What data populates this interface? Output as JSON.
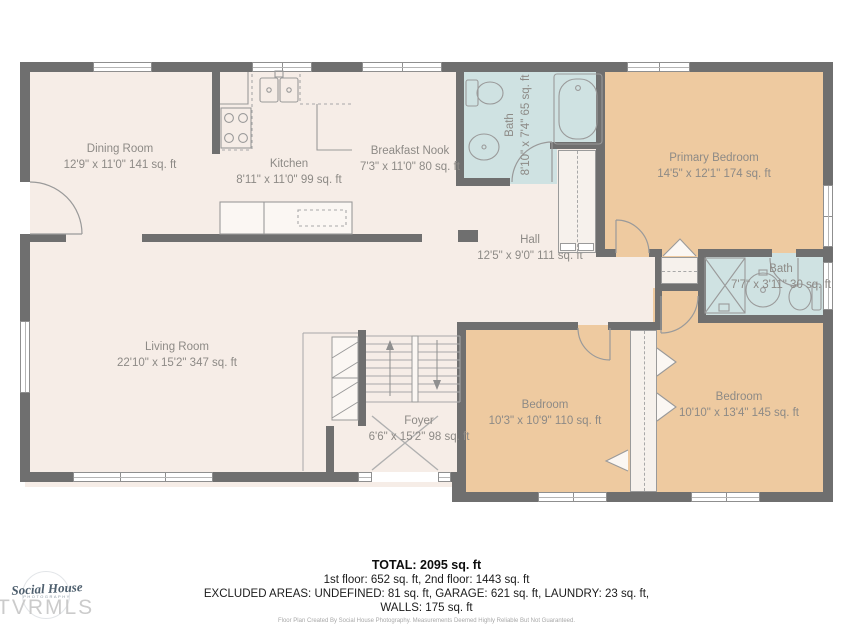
{
  "rooms": {
    "dining": {
      "name": "Dining Room",
      "dims": "12'9\" x 11'0\" 141 sq. ft"
    },
    "kitchen": {
      "name": "Kitchen",
      "dims": "8'11\" x 11'0\" 99 sq. ft"
    },
    "breakfast": {
      "name": "Breakfast Nook",
      "dims": "7'3\" x 11'0\" 80 sq. ft"
    },
    "bath_upper": {
      "name": "Bath",
      "dims": "8'10\" x 7'4\" 65 sq. ft"
    },
    "hall": {
      "name": "Hall",
      "dims": "12'5\" x 9'0\" 111 sq. ft"
    },
    "primary": {
      "name": "Primary Bedroom",
      "dims": "14'5\" x 12'1\" 174 sq. ft"
    },
    "bath_small": {
      "name": "Bath",
      "dims": "7'7\" x 3'11\" 30 sq. ft"
    },
    "living": {
      "name": "Living Room",
      "dims": "22'10\" x 15'2\" 347 sq. ft"
    },
    "foyer": {
      "name": "Foyer",
      "dims": "6'6\" x 15'2\" 98 sq. ft"
    },
    "bedroom1": {
      "name": "Bedroom",
      "dims": "10'3\" x 10'9\" 110 sq. ft"
    },
    "bedroom2": {
      "name": "Bedroom",
      "dims": "10'10\" x 13'4\" 145 sq. ft"
    }
  },
  "summary": {
    "total": "TOTAL: 2095 sq. ft",
    "floors": "1st floor: 652 sq. ft, 2nd floor: 1443 sq. ft",
    "excluded": "EXCLUDED AREAS: UNDEFINED: 81 sq. ft, GARAGE: 621 sq. ft, LAUNDRY: 23 sq. ft,",
    "walls": "WALLS: 175 sq. ft",
    "credit": "Floor Plan Created By Social House Photography. Measurements Deemed Highly Reliable But Not Guaranteed."
  },
  "branding": {
    "logo_name": "Social House",
    "logo_sub": "PHOTOGRAPHY",
    "watermark": "TVRMLS"
  },
  "colors": {
    "wall": "#6f6f6f",
    "floor": "#f6ede7",
    "bedroom": "#eecaa0",
    "bath": "#cfe2e2",
    "label": "#8d8a86"
  }
}
